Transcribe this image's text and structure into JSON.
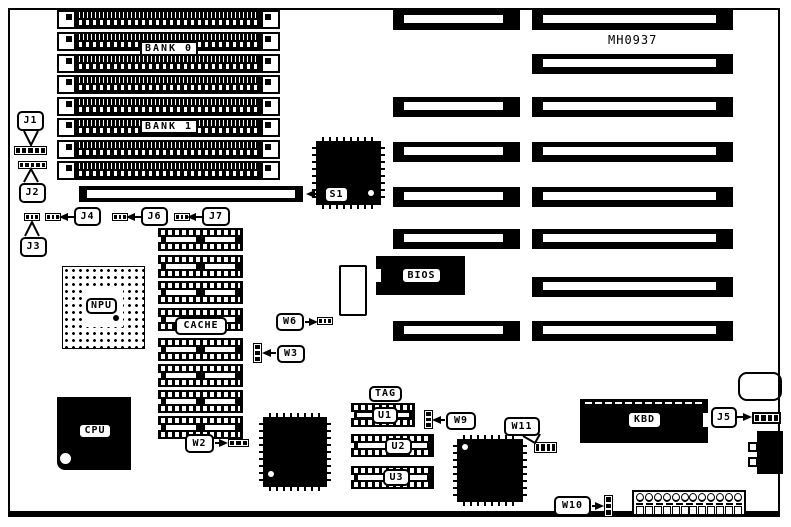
{
  "diagram": {
    "type": "motherboard-layout",
    "part_number": "MH0937",
    "memory": {
      "bank0": "BANK 0",
      "bank1": "BANK 1",
      "simm_socket_rows": 8
    },
    "chips": {
      "s1": "S1",
      "npu": "NPU",
      "cpu": "CPU",
      "cache": "CACHE",
      "bios": "BIOS",
      "tag": "TAG",
      "u1": "U1",
      "u2": "U2",
      "u3": "U3",
      "kbd": "KBD"
    },
    "jumpers": {
      "j1": "J1",
      "j2": "J2",
      "j3": "J3",
      "j4": "J4",
      "j5": "J5",
      "j6": "J6",
      "j7": "J7",
      "w2": "W2",
      "w3": "W3",
      "w6": "W6",
      "w9": "W9",
      "w10": "W10",
      "w11": "W11"
    },
    "expansion_slots": {
      "left_column_count": 6,
      "right_column_count": 8
    },
    "colors": {
      "ink": "#000000",
      "paper": "#ffffff"
    }
  }
}
